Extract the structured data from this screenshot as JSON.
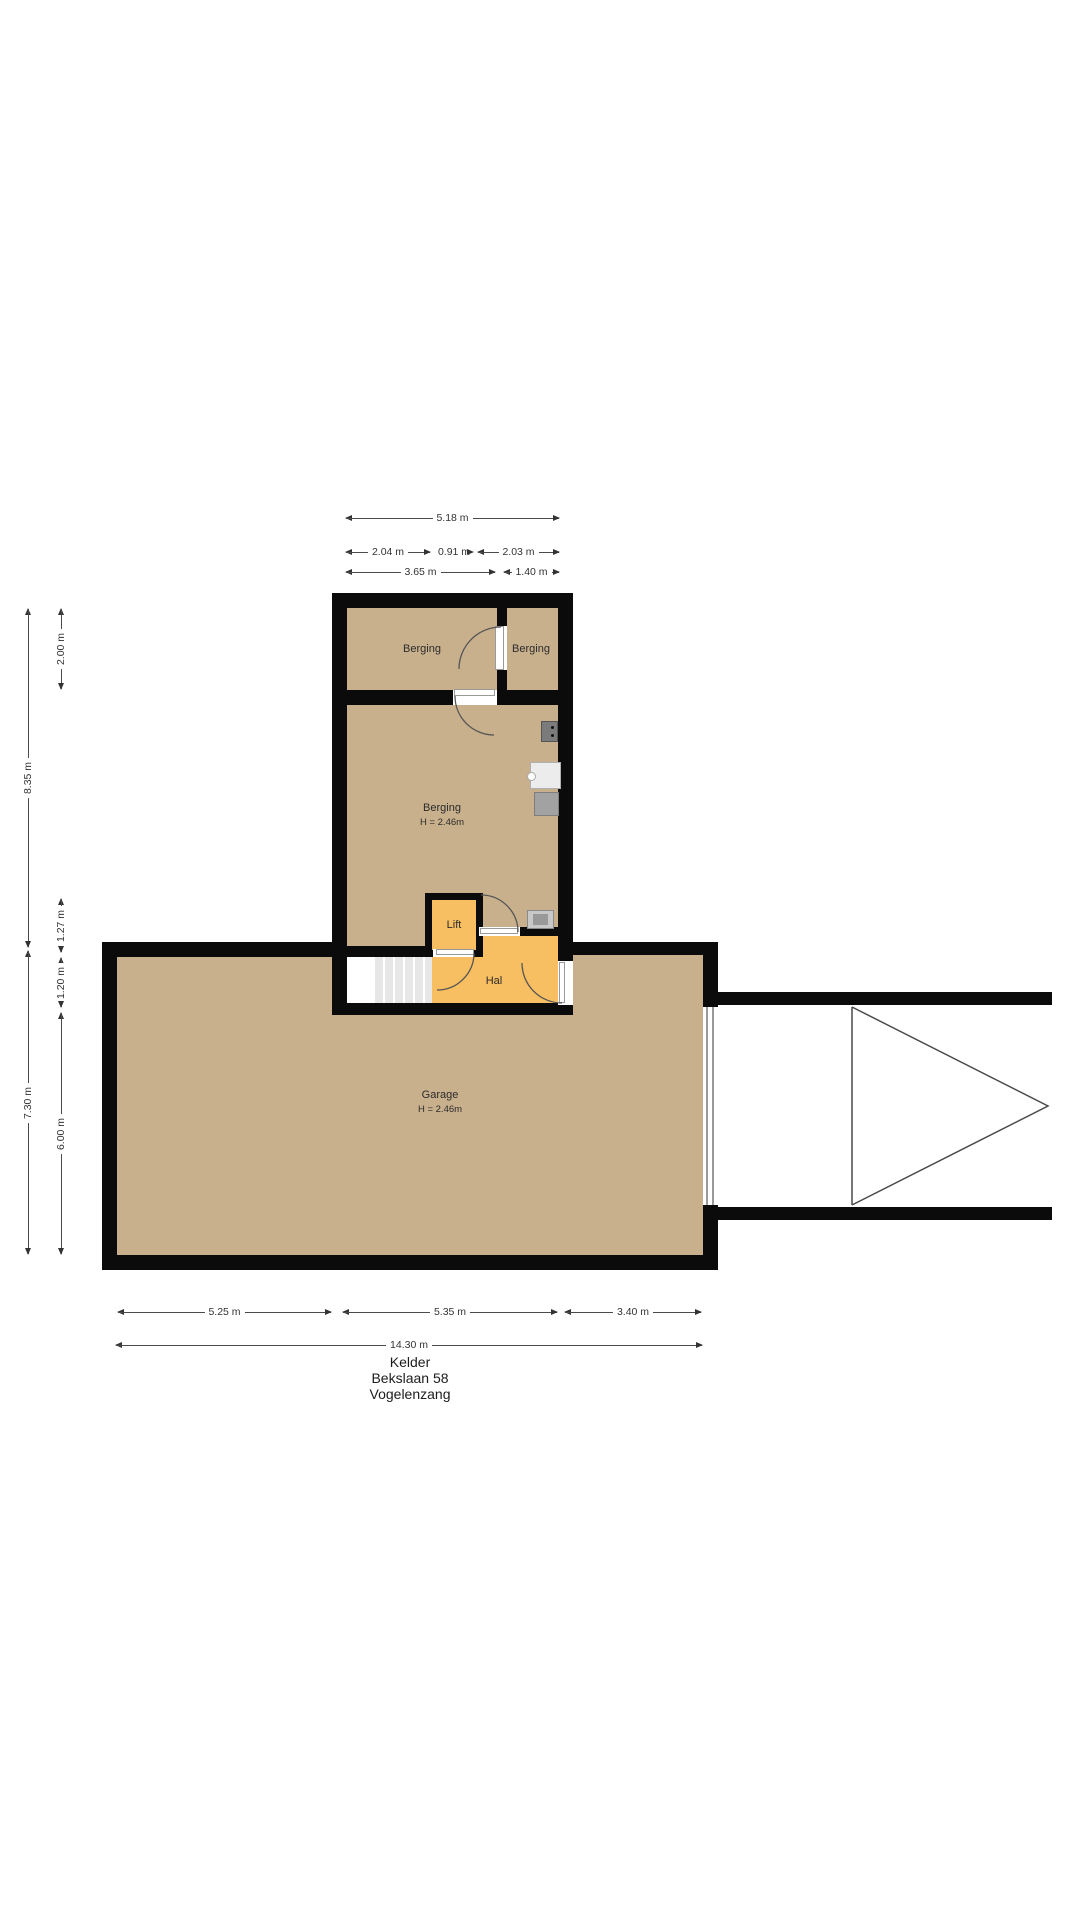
{
  "colors": {
    "wall": "#0b0b0b",
    "floor_tan": "#c9b08d",
    "floor_accent": "#f7be62"
  },
  "rooms": {
    "berging_top_left": "Berging",
    "berging_top_right": "Berging",
    "berging_main": "Berging",
    "berging_main_height": "H = 2.46m",
    "lift": "Lift",
    "hal": "Hal",
    "garage": "Garage",
    "garage_height": "H = 2.46m"
  },
  "dimensions": {
    "top_total": "5.18 m",
    "top_a": "2.04 m",
    "top_b": "0.91 m",
    "top_c": "2.03 m",
    "top_d": "3.65 m",
    "top_e": "1.40 m",
    "left_total_upper": "8.35 m",
    "left_total_lower": "7.30 m",
    "left_a": "2.00 m",
    "left_b": "1.27 m",
    "left_c": "1.20 m",
    "left_d": "6.00 m",
    "bottom_a": "5.25 m",
    "bottom_b": "5.35 m",
    "bottom_c": "3.40 m",
    "bottom_total": "14.30 m"
  },
  "title": {
    "floor": "Kelder",
    "address": "Bekslaan 58",
    "city": "Vogelenzang"
  }
}
